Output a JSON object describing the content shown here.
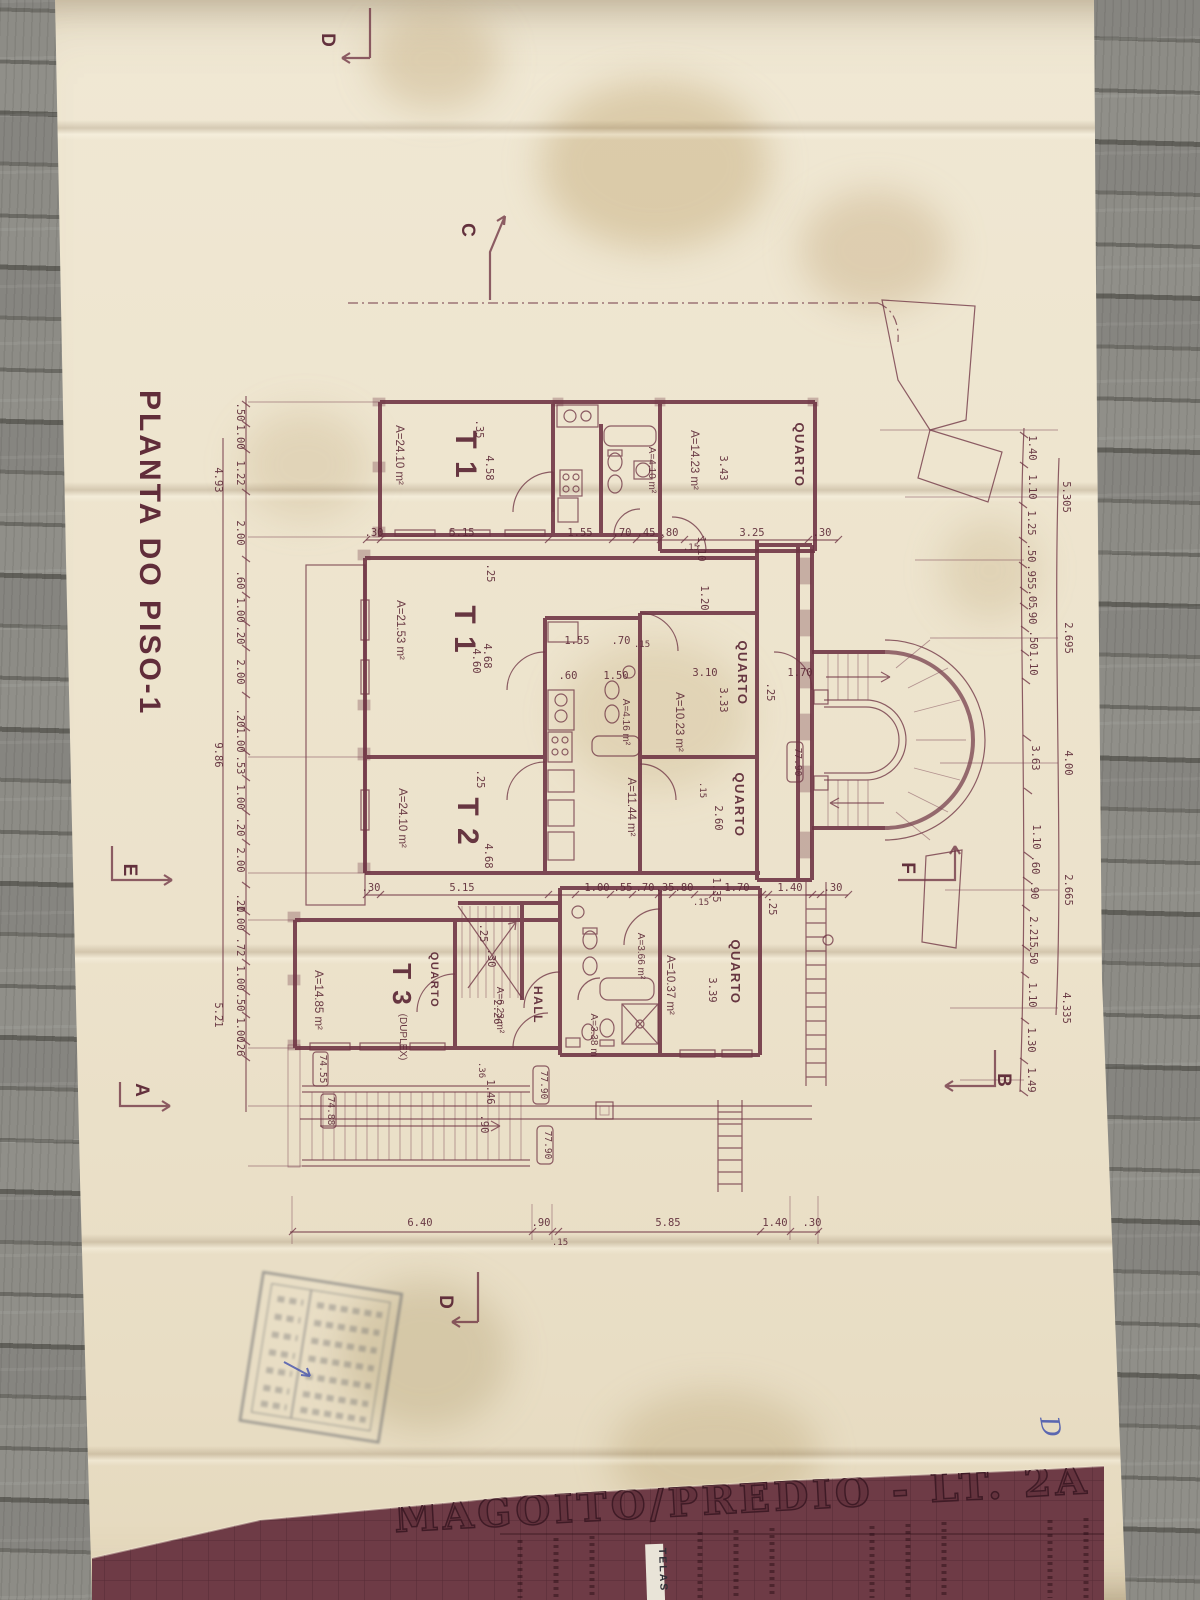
{
  "palette": {
    "ink": "#6f3544",
    "paper": "#ece2cb",
    "band": "#6e3b46",
    "blue": "#4353ae"
  },
  "title": "PLANTA DO PISO-1",
  "markers": {
    "d_top": "D",
    "c": "C",
    "e": "E",
    "f": "F",
    "a": "A",
    "b": "B",
    "d_bottom": "D"
  },
  "rooms": {
    "t1_top": {
      "name": "T 1",
      "area": "A=24.10 m²"
    },
    "bath_top": {
      "area": "A=4.10 m²"
    },
    "quarto_top": {
      "name": "QUARTO",
      "area": "A=14.23 m²"
    },
    "t1_mid": {
      "name": "T 1",
      "area": "A=21.53 m²"
    },
    "bath_mid": {
      "area": "A=4.16 m²"
    },
    "quarto_1023": {
      "name": "QUARTO",
      "area": "A=10.23 m²"
    },
    "quarto_1144": {
      "name": "QUARTO",
      "area": "A=11.44 m²"
    },
    "t2": {
      "name": "T 2",
      "area": "A=24.10 m²"
    },
    "t3": {
      "name": "T 3",
      "type": "(DUPLEX)",
      "area": "A=14.85 m²",
      "bedroom": "QUARTO"
    },
    "hall": {
      "name": "HALL",
      "area": "A=6.23 m²"
    },
    "bath_366": {
      "area": "A=3.66 m²"
    },
    "wc_338": {
      "area": "A=3.38 m"
    },
    "quarto_1037": {
      "name": "QUARTO",
      "area": "A=10.37 m²"
    }
  },
  "levels": {
    "stair": "77.90",
    "walk1": "77.90",
    "walk2": "77.90",
    "ext1": "74.55",
    "ext2": "74.88"
  },
  "dims": {
    "left_chain": [
      ".50",
      "1.00",
      "1.22",
      "2.00",
      ".60",
      "1.00",
      ".20",
      "2.00",
      ".20",
      "1.00",
      ".53",
      "1.00",
      ".20",
      "2.00",
      ".20",
      "1.00",
      ".72",
      "1.00",
      ".50",
      "1.00",
      ".26"
    ],
    "left_totals": [
      "4.93",
      "9.86",
      "5.21"
    ],
    "right_chain": [
      "1.40",
      "1.10",
      "1.25",
      ".50",
      ".955",
      ".05",
      ".90",
      ".50",
      "1.10",
      "3.63",
      "1.10",
      ".60",
      ".90",
      "2.215",
      ".50",
      "1.10",
      "1.30",
      "1.49"
    ],
    "right_totals": [
      "5.305",
      "2.695",
      "4.00",
      "2.665",
      "4.335"
    ],
    "row1": [
      ".30",
      "5.15",
      "1.55",
      ".70",
      ".45",
      ".80",
      ".15",
      "3.25",
      ".30"
    ],
    "row2": [
      ".30",
      "5.15",
      "1.00",
      ".55",
      ".70",
      ".35",
      ".80",
      ".15",
      "1.70",
      "1.40",
      ".30"
    ],
    "row3": [
      "6.40",
      ".90",
      ".15",
      "5.85",
      "1.40",
      ".30"
    ],
    "inner": [
      "1.10",
      "1.20",
      ".35",
      "4.58",
      "3.43",
      ".25",
      "4.68",
      "4.60",
      "1.55",
      ".70",
      ".15",
      ".60",
      "1.50",
      "3.10",
      "3.33",
      "1.70",
      ".25",
      "2.60",
      ".15",
      "1.35",
      ".25",
      "4.68",
      "2.26",
      "3.39",
      "1.46",
      ".90",
      ".30",
      ".25",
      ".36",
      ".25"
    ]
  },
  "title_block": {
    "project": "MAGOITO/PRÉDIO - LT. 2A",
    "sticker": "TELAS"
  },
  "note": {
    "handwritten": "D"
  }
}
